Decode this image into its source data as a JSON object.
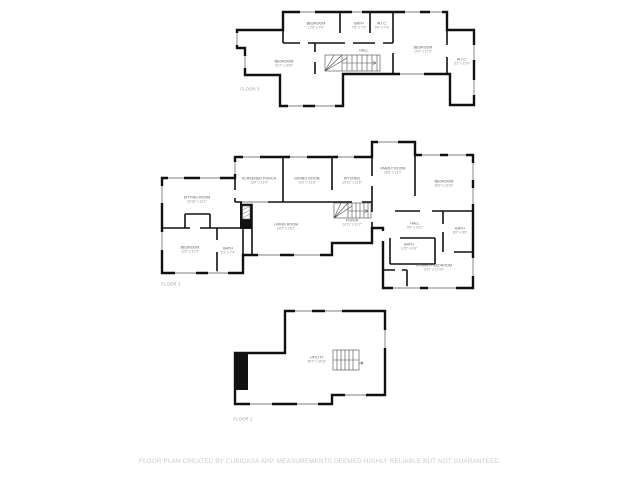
{
  "footer": {
    "text": "FLOOR PLAN CREATED BY CUBICASA APP. MEASUREMENTS DEEMED HIGHLY RELIABLE BUT NOT GUARANTEED."
  },
  "colors": {
    "background": "#ffffff",
    "wall": "#111111",
    "room_name": "#565656",
    "room_dims": "#8d8d8d",
    "floor_label": "#9b9b9b",
    "footer_text": "#c9c9c9"
  },
  "icons": [
    "stairs-icon",
    "chimney-icon",
    "window-icon"
  ],
  "floors": [
    {
      "name": "FLOOR 3",
      "rooms": [
        {
          "name": "BEDROOM",
          "dims": "12'6\" x 7'6\""
        },
        {
          "name": "BATH",
          "dims": "7'6\" x 7'6\""
        },
        {
          "name": "W.I.C.",
          "dims": "5'5\" x 7'4\""
        },
        {
          "name": "BEDROOM",
          "dims": "21'2\" x 20'6\""
        },
        {
          "name": "HALL"
        },
        {
          "name": "BEDROOM",
          "dims": "14'2\" x 17'0\""
        },
        {
          "name": "W.I.C.",
          "dims": "5'1\" x 10'9\""
        }
      ]
    },
    {
      "name": "FLOOR 2",
      "rooms": [
        {
          "name": "SCREENED PORCH",
          "dims": "13'4\" x 11'4\""
        },
        {
          "name": "DINING ROOM",
          "dims": "13'2\" x 11'8\""
        },
        {
          "name": "KITCHEN",
          "dims": "10'11\" x 11'6\""
        },
        {
          "name": "FAMILY ROOM",
          "dims": "16'9\" x 21'1\""
        },
        {
          "name": "BEDROOM",
          "dims": "16'3\" x 16'11\""
        },
        {
          "name": "SITTING ROOM",
          "dims": "15'10\" x 12'1\""
        },
        {
          "name": "LIVING ROOM",
          "dims": "20'2\" x 15'2\""
        },
        {
          "name": "FOYER",
          "dims": "10'11\" x 11'2\""
        },
        {
          "name": "HALL",
          "dims": "8'0\" x 4'11\""
        },
        {
          "name": "BATH",
          "dims": "12'9\" x 4'6\""
        },
        {
          "name": "BATH",
          "dims": "8'6\" x 9'9\""
        },
        {
          "name": "BEDROOM",
          "dims": "13'2\" x 11'4\""
        },
        {
          "name": "BATH",
          "dims": "5'1\" x 7'4\""
        },
        {
          "name": "PRIMARY BEDROOM",
          "dims": "24'1\" x 17'10\""
        }
      ]
    },
    {
      "name": "FLOOR 1",
      "rooms": [
        {
          "name": "UTILITY",
          "dims": "36'7\" x 24'11\""
        }
      ]
    }
  ]
}
